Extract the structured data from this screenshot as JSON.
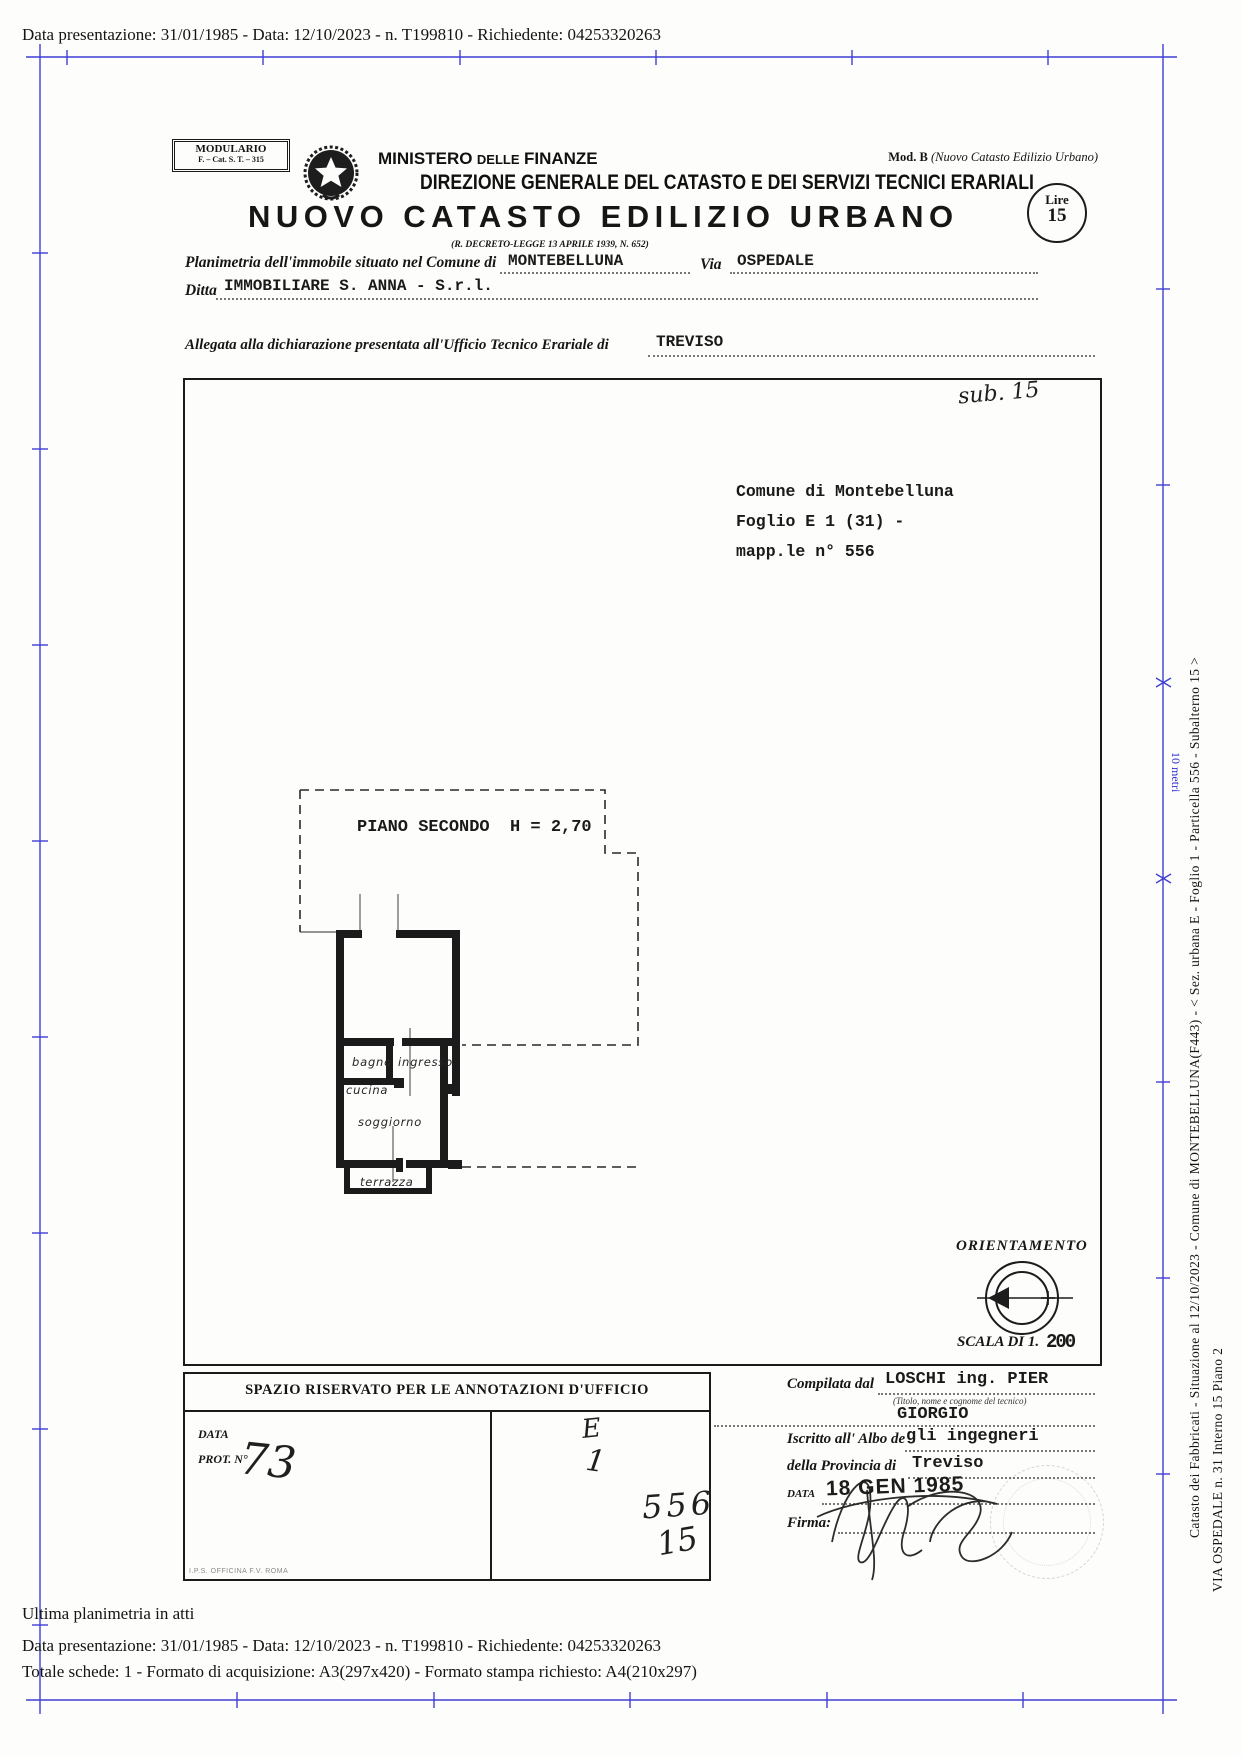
{
  "top_bar": {
    "text": "Data presentazione: 31/01/1985 - Data: 12/10/2023 - n. T199810 - Richiedente: 04253320263"
  },
  "header": {
    "modulario_line1": "MODULARIO",
    "modulario_line2": "F. – Cat. S. T. – 315",
    "mod_b_label": "Mod. B",
    "mod_b_paren": "(Nuovo Catasto Edilizio Urbano)",
    "lire_word": "Lire",
    "lire_value": "15",
    "ministero": {
      "w1": "MINISTERO",
      "w2": "DELLE",
      "w3": "FINANZE"
    },
    "direzione": "DIREZIONE GENERALE DEL CATASTO E DEI SERVIZI TECNICI ERARIALI",
    "title": "NUOVO CATASTO EDILIZIO URBANO",
    "decreto": "(R. DECRETO-LEGGE 13 APRILE 1939, N. 652)"
  },
  "fields": {
    "planimetria_label": "Planimetria dell'immobile situato nel Comune di",
    "comune_value": "MONTEBELLUNA",
    "via_label": "Via",
    "via_value": "OSPEDALE",
    "ditta_label": "Ditta",
    "ditta_value": "IMMOBILIARE S. ANNA - S.r.l.",
    "allegata_label": "Allegata alla dichiarazione presentata all'Ufficio Tecnico Erariale di",
    "erariale_value": "TREVISO"
  },
  "plan": {
    "sub_note": "sub. 15",
    "comune_block_line1": "Comune di Montebelluna",
    "comune_block_line2": "Foglio E 1 (31) -",
    "comune_block_line3": "mapp.le n° 556",
    "piano_line": "PIANO SECONDO  H = 2,70",
    "rooms": {
      "bagno": "bagno",
      "ingresso": "ingresso",
      "cucina": "cucina",
      "soggiorno": "soggiorno",
      "terrazza": "terrazza"
    },
    "orientamento_label": "ORIENTAMENTO",
    "scala_label": "SCALA DI 1.",
    "scala_value": "200"
  },
  "annotazioni": {
    "header": "SPAZIO RISERVATO PER LE ANNOTAZIONI D'UFFICIO",
    "data_label": "DATA",
    "prot_label": "PROT. N°",
    "prot_value_hand": "73",
    "hand_column": [
      "E",
      "1",
      "556",
      "15"
    ],
    "officina_note": "I.P.S. OFFICINA F.V. ROMA"
  },
  "compilata": {
    "compilata_label": "Compilata dal",
    "tecnico_line1": "LOSCHI ing. PIER",
    "titolo_note": "(Titolo, nome e cognome del tecnico)",
    "tecnico_line2": "GIORGIO",
    "iscritto_label": "Iscritto all' Albo de",
    "albo_value": "gli ingegneri",
    "provincia_label": "della Provincia di",
    "provincia_value": "Treviso",
    "data_label": "DATA",
    "data_stamp": "18 GEN 1985",
    "firma_label": "Firma:"
  },
  "side": {
    "ruler_label": "10 metri",
    "line1": "Catasto dei Fabbricati -  Situazione al 12/10/2023 - Comune di MONTEBELLUNA(F443) - < Sez. urbana E - Foglio 1 - Particella  556 - Subalterno 15 >",
    "line2": "VIA OSPEDALE n. 31  Interno 15 Piano 2"
  },
  "footer": {
    "line1": "Ultima planimetria in atti",
    "line2": "Data presentazione: 31/01/1985 - Data: 12/10/2023 - n. T199810 - Richiedente: 04253320263",
    "line3": "Totale schede: 1 - Formato di acquisizione: A3(297x420) - Formato stampa richiesto: A4(210x297)"
  },
  "colors": {
    "frame_blue": "#2b2bd0",
    "ink": "#141414"
  }
}
